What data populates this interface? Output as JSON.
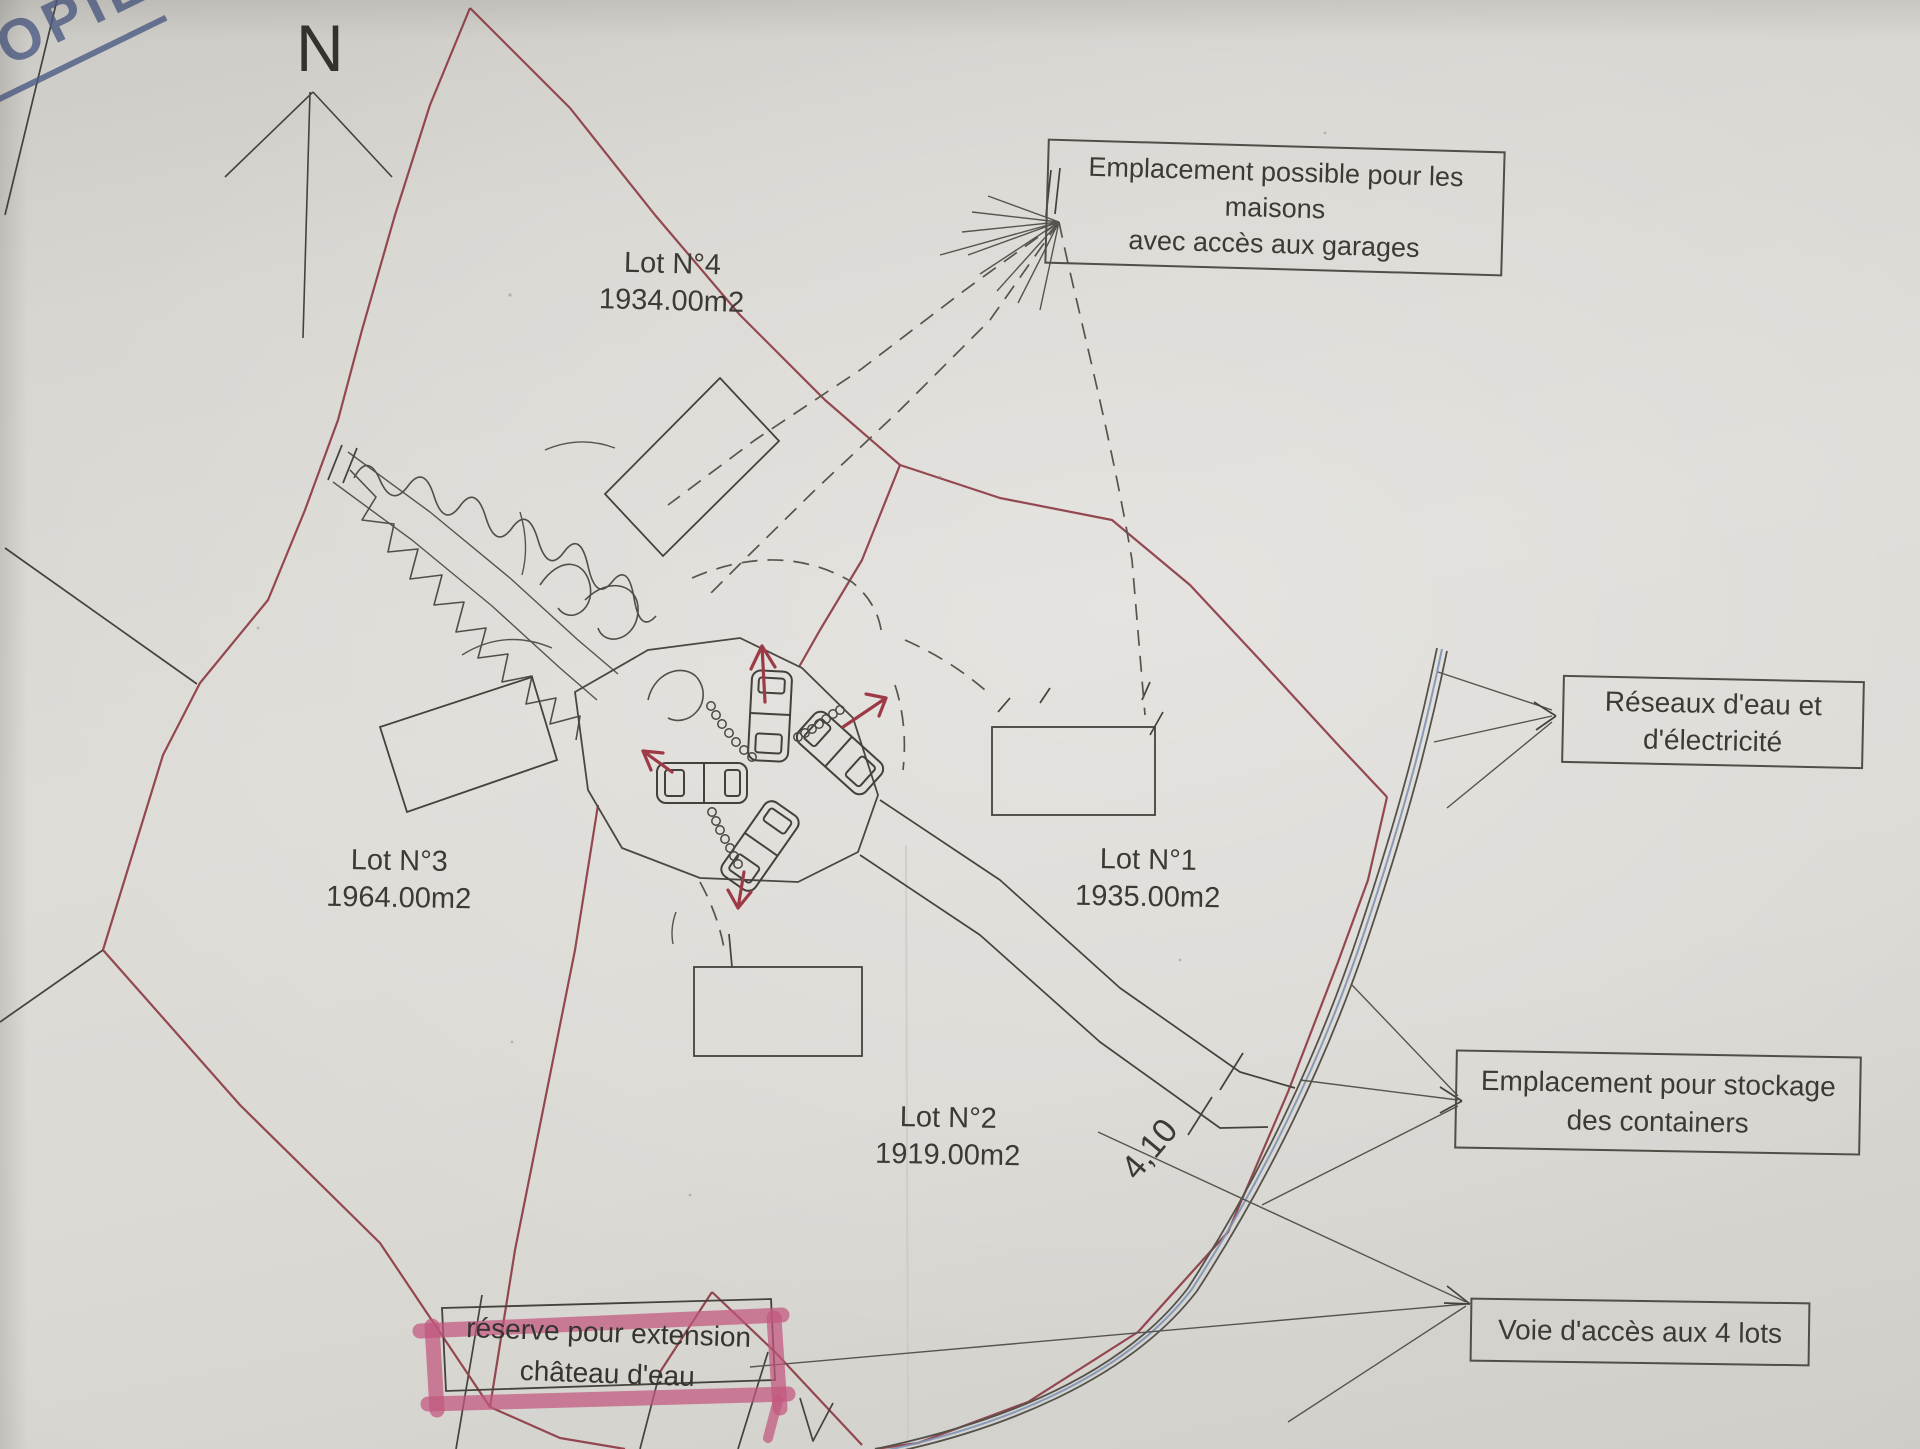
{
  "stamp": {
    "text": "COPIE",
    "color": "#4d5c86"
  },
  "compass": {
    "label": "N"
  },
  "lots": [
    {
      "id": "lot-1",
      "name": "Lot N°1",
      "area": "1935.00m2"
    },
    {
      "id": "lot-2",
      "name": "Lot N°2",
      "area": "1919.00m2"
    },
    {
      "id": "lot-3",
      "name": "Lot N°3",
      "area": "1964.00m2"
    },
    {
      "id": "lot-4",
      "name": "Lot N°4",
      "area": "1934.00m2"
    }
  ],
  "annotations": [
    {
      "id": "maisons",
      "lines": [
        "Emplacement possible pour les",
        "maisons",
        "avec accès aux garages"
      ]
    },
    {
      "id": "reseaux",
      "lines": [
        "Réseaux d'eau et",
        "d'électricité"
      ]
    },
    {
      "id": "stockage",
      "lines": [
        "Emplacement pour stockage",
        "des containers"
      ]
    },
    {
      "id": "voie",
      "lines": [
        "Voie d'accès aux 4 lots"
      ]
    },
    {
      "id": "reserve",
      "lines": [
        "réserve pour extension",
        "château d'eau"
      ],
      "highlight": "#c2567e"
    }
  ],
  "dimension": {
    "label": "4,10"
  },
  "colors": {
    "paper": "#dad8d3",
    "ink": "#45423d",
    "boundary": "#8e3f49",
    "road-blue": "#7d92b5",
    "highlight-pink": "#c2567e",
    "stamp-blue": "#4d5c86",
    "arrow-red": "#9c3a46"
  }
}
